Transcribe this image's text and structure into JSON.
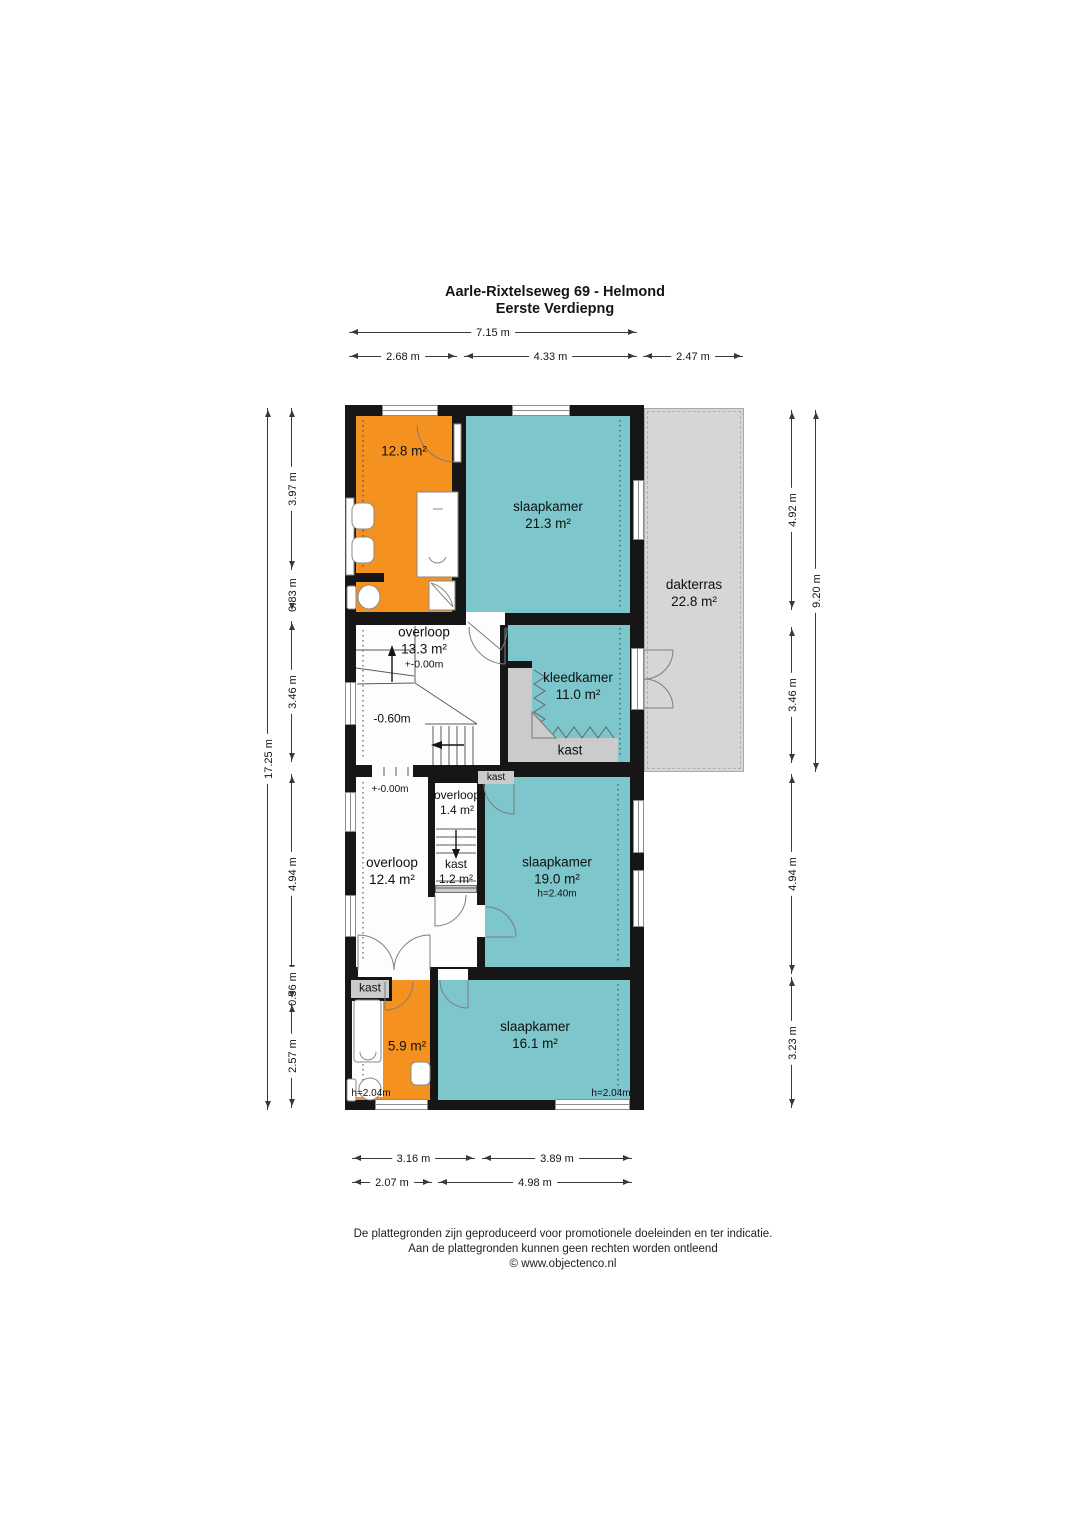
{
  "title": {
    "line1": "Aarle-Rixtelseweg 69 - Helmond",
    "line2": "Eerste Verdiepng"
  },
  "dims": {
    "top_total": "7.15 m",
    "top_segments": [
      "2.68 m",
      "4.33 m",
      "2.47 m"
    ],
    "left_total": "17.25 m",
    "left_segments": [
      "3.97 m",
      "0.83 m",
      "3.46 m",
      "4.94 m",
      "0.56 m",
      "2.57 m"
    ],
    "right_total": "9.20 m",
    "right_segments": [
      "4.92 m",
      "3.46 m",
      "4.94 m",
      "3.23 m"
    ],
    "bottom_row1": [
      "3.16 m",
      "3.89 m"
    ],
    "bottom_row2": [
      "2.07 m",
      "4.98 m"
    ]
  },
  "rooms": {
    "bathroom_top": {
      "area": "12.8 m²"
    },
    "bedroom_top": {
      "name": "slaapkamer",
      "area": "21.3 m²"
    },
    "roof_terrace": {
      "name": "dakterras",
      "area": "22.8 m²"
    },
    "landing_main": {
      "name": "overloop",
      "area": "13.3 m²",
      "level": "+-0.00m"
    },
    "landing_main_lower_level": "-0.60m",
    "dressing_room": {
      "name": "kleedkamer",
      "area": "11.0 m²"
    },
    "dressing_closet": {
      "name": "kast"
    },
    "closet_nook": {
      "name": "kast"
    },
    "landing_small": {
      "name": "overloop",
      "area": "1.4 m²"
    },
    "stair_closet": {
      "name": "kast",
      "area": "1.2 m²"
    },
    "landing_lower": {
      "name": "overloop",
      "area": "12.4 m²",
      "level": "+-0.00m"
    },
    "bedroom_middle": {
      "name": "slaapkamer",
      "area": "19.0 m²",
      "height": "h=2.40m"
    },
    "hall_closet": {
      "name": "kast"
    },
    "bathroom_bottom": {
      "area": "5.9 m²",
      "height": "h=2.04m"
    },
    "bedroom_bottom": {
      "name": "slaapkamer",
      "area": "16.1 m²",
      "height": "h=2.04m"
    }
  },
  "colors": {
    "room_accent_teal": "#7dc6cb",
    "room_accent_orange": "#f5921f",
    "terrace_gray": "#d6d6d6",
    "closet_gray": "#cbcbcb",
    "wall_black": "#161616"
  },
  "footer": {
    "line1": "De plattegronden zijn geproduceerd voor promotionele doeleinden en ter indicatie.",
    "line2": "Aan de plattegronden kunnen geen rechten worden ontleend",
    "line3": "© www.objectenco.nl"
  }
}
